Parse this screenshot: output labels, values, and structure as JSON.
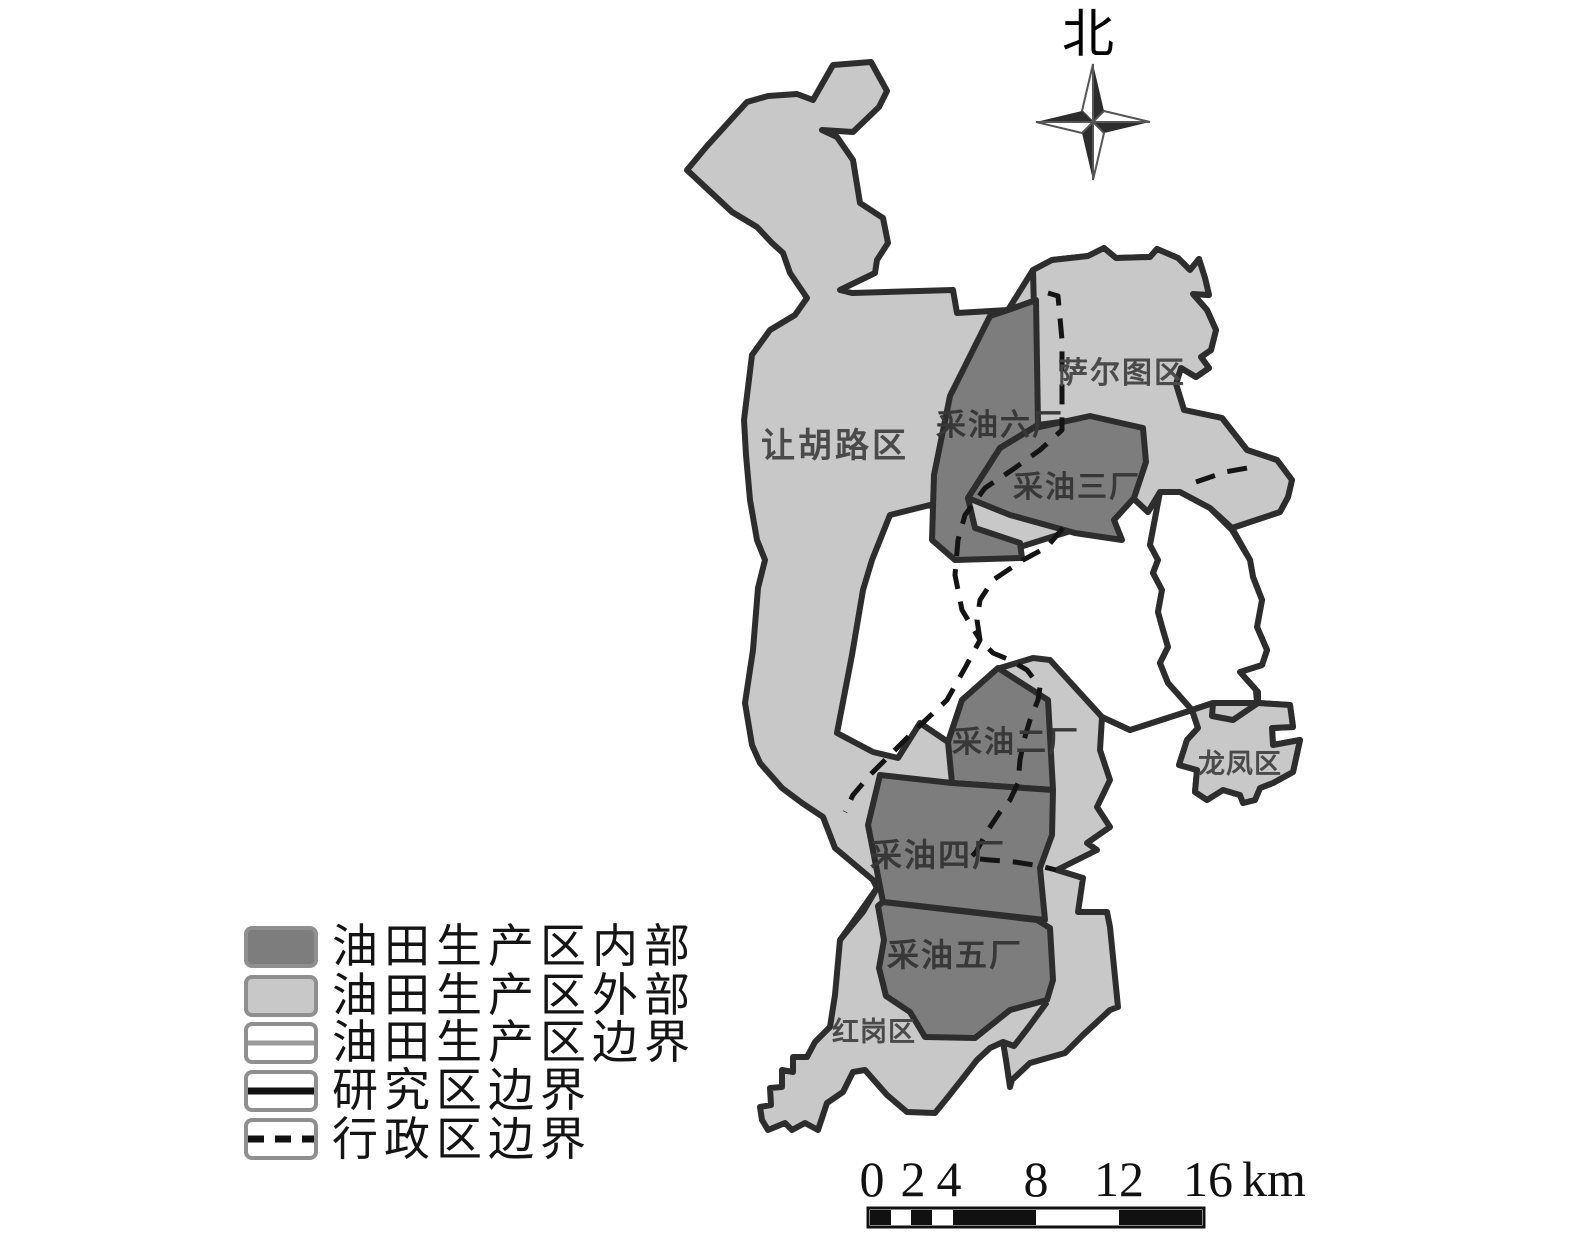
{
  "compass": {
    "label": "北"
  },
  "map": {
    "labels": {
      "ranghulu": "让胡路区",
      "saertu": "萨尔图区",
      "plant6": "采油六厂",
      "plant3": "采油三厂",
      "plant2": "采油二厂",
      "plant4": "采油四厂",
      "plant5": "采油五厂",
      "longfeng": "龙凤区",
      "honggang": "红岗区"
    }
  },
  "legend": {
    "items": [
      {
        "label": "油田生产区内部",
        "swatch": "dark-fill"
      },
      {
        "label": "油田生产区外部",
        "swatch": "light-fill"
      },
      {
        "label": "油田生产区边界",
        "swatch": "thin-gray-line"
      },
      {
        "label": "研究区边界",
        "swatch": "thick-black-line"
      },
      {
        "label": "行政区边界",
        "swatch": "dashed-black-line"
      }
    ]
  },
  "scale_bar": {
    "ticks": [
      "0",
      "2",
      "4",
      "8",
      "12",
      "16"
    ],
    "unit": "km"
  },
  "colors": {
    "production_area_interior": "#7d7d7d",
    "production_area_exterior": "#c8c8c8",
    "study_area_boundary": "#2d2d2d",
    "admin_boundary": "#141414",
    "map_label": "#4a4a4a",
    "background": "#ffffff"
  }
}
